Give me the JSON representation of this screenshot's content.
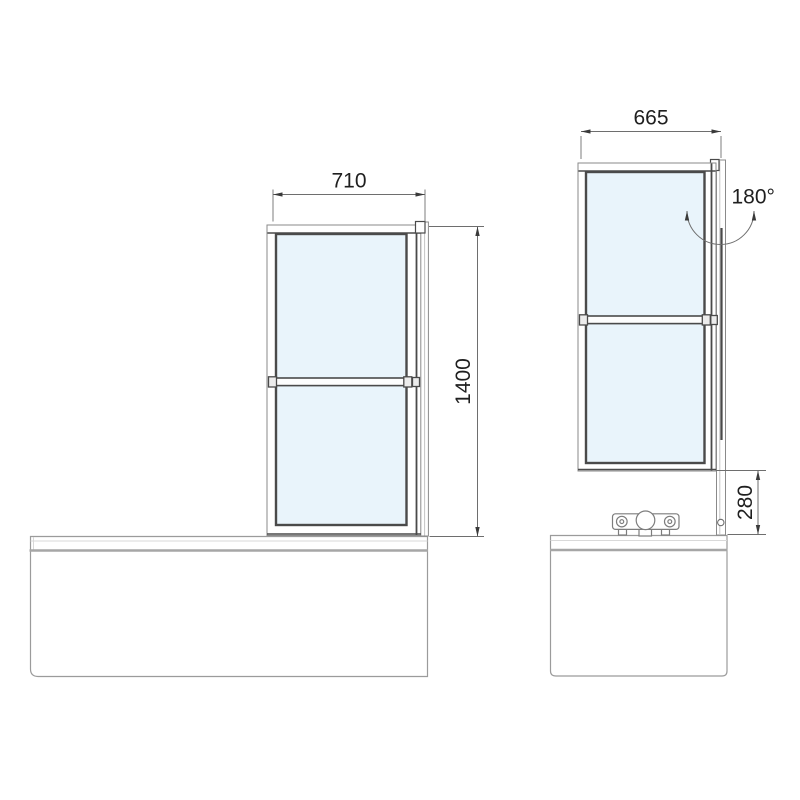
{
  "diagram": {
    "type": "technical-drawing",
    "subject": "folding-bath-shower-screen-over-bathtub",
    "views": {
      "front": {
        "dimensions": {
          "width": "710",
          "height": "1400"
        }
      },
      "side": {
        "dimensions": {
          "width": "665",
          "gap_above_tub": "280"
        },
        "rotation": "180°"
      }
    }
  },
  "colors": {
    "background": "#ffffff",
    "glass": "#e9f4fb",
    "frame-dark": "#4a4a4a",
    "frame-light": "#8a8a8a",
    "tub-line": "#9b9b9b",
    "tub-line-thick": "#a6a6a6",
    "tub-line-light": "#d9d9d9",
    "dim-line": "#6e6e6e",
    "text": "#1f1f1f"
  }
}
